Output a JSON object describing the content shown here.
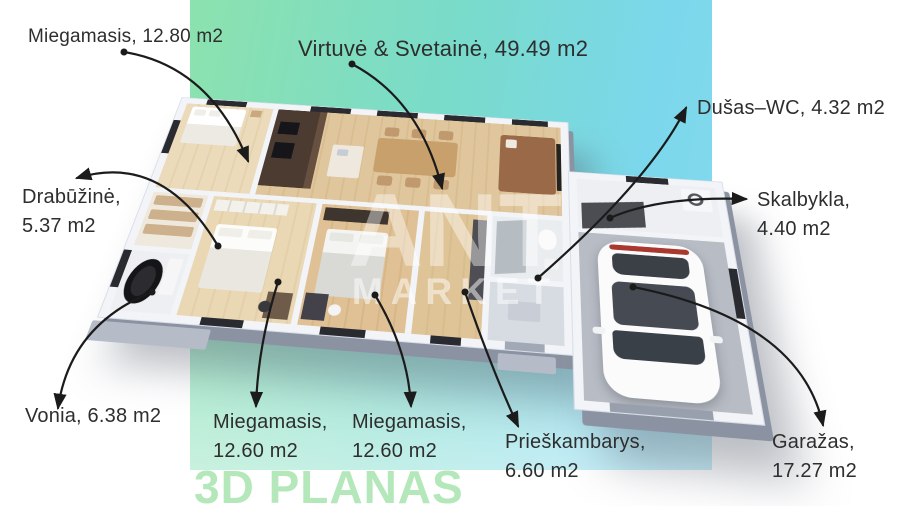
{
  "branding": {
    "watermark_line1": "ANT",
    "watermark_line2": "MARKET",
    "footer_title": "3D PLANAS"
  },
  "colors": {
    "gradient_green": "#8ce2ae",
    "gradient_teal": "#79dbca",
    "gradient_cyan": "#7bd7ec",
    "footer_title": "#b4e8ba",
    "label_text": "#2e2e2e",
    "arrow": "#1b1b1b",
    "wall": "#f2f4f8",
    "wood_floor": "#dfc49a",
    "garage_floor": "#b8bcc5",
    "kitchen_cabinets": "#4b3b31",
    "bathtub": "#151517",
    "car_body": "#fbfbfc"
  },
  "labels": [
    {
      "id": "bedroom-top-left",
      "lines": [
        "Miegamasis, 12.80 m2"
      ]
    },
    {
      "id": "kitchen-living",
      "lines": [
        "Virtuvė & Svetainė, 49.49 m2"
      ]
    },
    {
      "id": "shower-wc",
      "lines": [
        "Dušas–WC, 4.32 m2"
      ]
    },
    {
      "id": "laundry",
      "lines": [
        "Skalbykla,",
        "4.40 m2"
      ]
    },
    {
      "id": "walk-in-closet",
      "lines": [
        "Drabūžinė,",
        "5.37 m2"
      ]
    },
    {
      "id": "bathroom",
      "lines": [
        "Vonia, 6.38 m2"
      ]
    },
    {
      "id": "bedroom-bottom-1",
      "lines": [
        "Miegamasis,",
        "12.60 m2"
      ]
    },
    {
      "id": "bedroom-bottom-2",
      "lines": [
        "Miegamasis,",
        "12.60 m2"
      ]
    },
    {
      "id": "entrance-hall",
      "lines": [
        "Prieškambarys,",
        "6.60 m2"
      ]
    },
    {
      "id": "garage",
      "lines": [
        "Garažas,",
        "17.27 m2"
      ]
    }
  ]
}
